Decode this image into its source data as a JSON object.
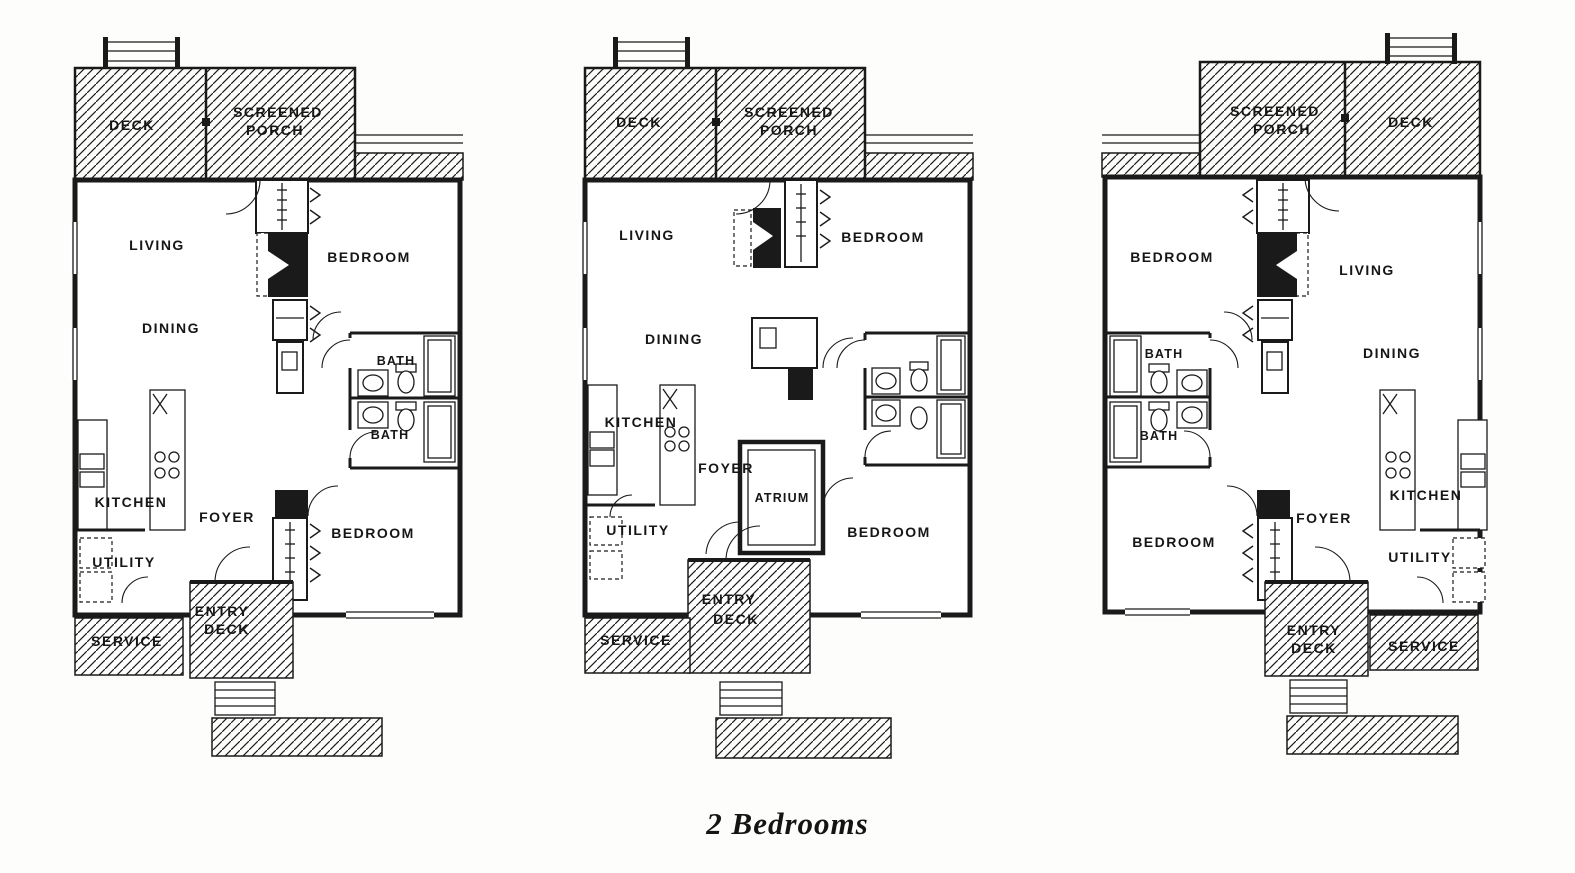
{
  "caption": "2 Bedrooms",
  "plans": [
    {
      "id": "left-unit",
      "labels": {
        "deck": "DECK",
        "screened": "SCREENED",
        "porch": "PORCH",
        "living": "LIVING",
        "dining": "DINING",
        "bedroom_upper": "BEDROOM",
        "bath_upper": "BATH",
        "bath_lower": "BATH",
        "kitchen": "KITCHEN",
        "foyer": "FOYER",
        "bedroom_lower": "BEDROOM",
        "utility": "UTILITY",
        "service": "SERVICE",
        "entry_line1": "ENTRY",
        "entry_line2": "DECK"
      }
    },
    {
      "id": "middle-unit",
      "labels": {
        "deck": "DECK",
        "screened": "SCREENED",
        "porch": "PORCH",
        "living": "LIVING",
        "dining": "DINING",
        "bedroom_upper": "BEDROOM",
        "kitchen": "KITCHEN",
        "foyer": "FOYER",
        "atrium": "ATRIUM",
        "utility": "UTILITY",
        "bedroom_lower": "BEDROOM",
        "service": "SERVICE",
        "entry_line1": "ENTRY",
        "entry_line2": "DECK"
      }
    },
    {
      "id": "right-unit",
      "labels": {
        "screened": "SCREENED",
        "porch": "PORCH",
        "deck": "DECK",
        "bedroom_upper": "BEDROOM",
        "living": "LIVING",
        "bath_upper": "BATH",
        "bath_lower": "BATH",
        "dining": "DINING",
        "kitchen": "KITCHEN",
        "foyer": "FOYER",
        "bedroom_lower": "BEDROOM",
        "utility": "UTILITY",
        "entry_line1": "ENTRY",
        "entry_line2": "DECK",
        "service": "SERVICE"
      }
    }
  ]
}
